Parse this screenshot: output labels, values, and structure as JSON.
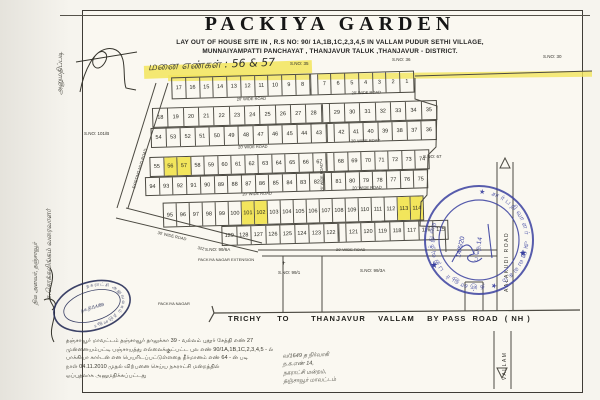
{
  "title": "PACKIYA GARDEN",
  "subtitle1": "LAY OUT OF HOUSE SITE IN , R.S NO: 90/ 1A,1B,1C,2,3,4,5 IN VALLAM PUDUR SETHI VILLAGE,",
  "subtitle2": "MUNNAIYAMPATTI PANCHAYAT , THANJAVUR TALUK ,THANJAVUR - DISTRICT.",
  "handwritten_note": "மனை எண்கள் : 56 & 57",
  "colors": {
    "highlight": "#f2e55c",
    "stamp_blue": "#3a41a0",
    "stamp_dark": "#272e58",
    "ink": "#2b2b2b"
  },
  "layout": {
    "highlighted_plots": [
      "56",
      "57",
      "101",
      "102",
      "113",
      "114"
    ],
    "rows": [
      {
        "x": 172,
        "y": 78,
        "w": 243,
        "h": 22,
        "gap_after": 9,
        "cells": [
          "17",
          "16",
          "15",
          "14",
          "13",
          "12",
          "11",
          "10",
          "9",
          "8",
          "7",
          "6",
          "5",
          "4",
          "3",
          "2",
          "1"
        ]
      },
      {
        "x": 152,
        "y": 108,
        "w": 285,
        "h": 20,
        "gap_after": 10,
        "cells": [
          "18",
          "19",
          "20",
          "21",
          "22",
          "23",
          "24",
          "25",
          "26",
          "27",
          "28",
          "29",
          "30",
          "31",
          "32",
          "33",
          "34",
          "35"
        ]
      },
      {
        "x": 150,
        "y": 128,
        "w": 286,
        "h": 20,
        "gap_after": 11,
        "cells": [
          "54",
          "53",
          "52",
          "51",
          "50",
          "49",
          "48",
          "47",
          "46",
          "45",
          "44",
          "43",
          "42",
          "41",
          "40",
          "39",
          "38",
          "37",
          "36"
        ]
      },
      {
        "x": 148,
        "y": 157,
        "w": 280,
        "h": 20,
        "gap_after": 12,
        "cells": [
          "55",
          "56",
          "57",
          "58",
          "59",
          "60",
          "61",
          "62",
          "63",
          "64",
          "65",
          "66",
          "67",
          "68",
          "69",
          "70",
          "71",
          "72",
          "73",
          "74"
        ]
      },
      {
        "x": 143,
        "y": 177,
        "w": 283,
        "h": 19,
        "gap_after": 12,
        "cells": [
          "94",
          "93",
          "92",
          "91",
          "90",
          "89",
          "88",
          "87",
          "86",
          "85",
          "84",
          "83",
          "82",
          "81",
          "80",
          "79",
          "78",
          "77",
          "76",
          "75"
        ]
      },
      {
        "x": 160,
        "y": 203,
        "w": 261,
        "h": 25,
        "cells": [
          "95",
          "96",
          "97",
          "98",
          "99",
          "100",
          "101",
          "102",
          "103",
          "104",
          "105",
          "106",
          "107",
          "108",
          "109",
          "110",
          "111",
          "112",
          "113",
          "114"
        ]
      },
      {
        "x": 218,
        "y": 228,
        "w": 227,
        "h": 20,
        "gap_after": 7,
        "cells": [
          "129",
          "128",
          "127",
          "126",
          "125",
          "124",
          "123",
          "122",
          "121",
          "120",
          "119",
          "118",
          "117",
          "116",
          "115"
        ]
      }
    ],
    "grid_labels": [
      {
        "name": "road-20-label-1",
        "t": "20' WIDE ROAD",
        "x": 237,
        "y": 100,
        "s": 4
      },
      {
        "name": "road-20-label-2",
        "t": "20' WIDE ROAD",
        "x": 352,
        "y": 97,
        "s": 4
      },
      {
        "name": "road-20-label-3",
        "t": "20' WIDE ROAD",
        "x": 237,
        "y": 148,
        "s": 4
      },
      {
        "name": "road-20-label-4",
        "t": "20' WIDE ROAD",
        "x": 350,
        "y": 145,
        "s": 4
      },
      {
        "name": "road-20-label-5",
        "t": "20' WIDE ROAD",
        "x": 240,
        "y": 195,
        "s": 4
      },
      {
        "name": "road-20-label-6",
        "t": "20' WIDE ROAD",
        "x": 350,
        "y": 192,
        "s": 4
      },
      {
        "name": "road-20-vertical-label",
        "t": "20' WIDE ROAD",
        "x": 319,
        "y": 196,
        "s": 3.8,
        "r": -90
      }
    ],
    "page_labels": [
      {
        "name": "survey-no-35",
        "t": "S.NO: 35",
        "x": 290,
        "y": 62,
        "s": 4.5
      },
      {
        "name": "survey-no-36",
        "t": "S.NO: 36",
        "x": 392,
        "y": 58,
        "s": 4.5
      },
      {
        "name": "survey-no-30",
        "t": "S.NO: 30",
        "x": 543,
        "y": 55,
        "s": 4.5
      },
      {
        "name": "survey-no-101b",
        "t": "S.NO: 101/B",
        "x": 84,
        "y": 132,
        "s": 4.5
      },
      {
        "name": "survey-no-67",
        "t": "S.NO: 67",
        "x": 423,
        "y": 155,
        "s": 4.5
      },
      {
        "name": "survey-no-99-6a",
        "t": "S.NO: 99/6A",
        "x": 205,
        "y": 248,
        "s": 4.5
      },
      {
        "name": "survey-no-99-1",
        "t": "S.NO: 99/1",
        "x": 278,
        "y": 271,
        "s": 4.5
      },
      {
        "name": "survey-no-99-3a",
        "t": "S.NO: 99/3A",
        "x": 360,
        "y": 269,
        "s": 4.5
      },
      {
        "name": "cross-mark",
        "t": "+",
        "x": 282,
        "y": 261,
        "s": 6
      },
      {
        "name": "road-20-bottom-label",
        "t": "20' WIDE ROAD",
        "x": 336,
        "y": 248,
        "s": 4
      },
      {
        "name": "road-30-label",
        "t": "30' WIDE ROAD",
        "x": 158,
        "y": 231,
        "s": 4,
        "r": 13
      },
      {
        "name": "dim-322",
        "t": "322'",
        "x": 198,
        "y": 246,
        "s": 4,
        "r": 13
      },
      {
        "name": "mud-road-label",
        "t": "EXISTING MUD ROAD",
        "x": 132,
        "y": 188,
        "s": 4,
        "r": -73
      },
      {
        "name": "aalakudi-road-label",
        "t": "AALAKUDI  ROAD",
        "x": 505,
        "y": 292,
        "s": 5,
        "r": -90,
        "cls": "ls1"
      },
      {
        "name": "vallam-label",
        "t": "VALLAM",
        "x": 503,
        "y": 380,
        "s": 5,
        "r": -90,
        "cls": "ls1"
      },
      {
        "name": "packiya-nagar-extension-label",
        "t": "PACKIYA NAGAR EXTENSION",
        "x": 198,
        "y": 258,
        "s": 4
      },
      {
        "name": "packiya-nagar-label",
        "t": "PACKIYA NAGAR",
        "x": 158,
        "y": 302,
        "s": 4
      },
      {
        "name": "bypass-road-label",
        "t": "TRICHY     TO       THANJAVUR    VALLAM    BY PASS  ROAD  ( NH )",
        "x": 228,
        "y": 315,
        "s": 7.5,
        "cls": "pre"
      }
    ]
  },
  "stamps": {
    "round": {
      "ring": "★ சார்பதிவாளர் அலுவலகம் ★ தஞ்சாவூர் பதிவுத்துறை",
      "line1": "14/6/20",
      "line2": "ப.நெ.14"
    },
    "oval": {
      "ring": "நகராட்சி அலுவலகம் தஞ்சாவூர்",
      "center": "நக.நி/14/89"
    }
  },
  "bottom_text": {
    "lines": [
      "தஞ்சாவூர் மாவட்டம் தஞ்சாவூர் தாலுக்கா 39 - வல்லம் புதூர் சேத்தி எண் 27",
      "முன்னையம்பட்டி பஞ்சாயத்து எல்லைக்குட்பட்ட புல எண் 90/1A,1B,1C,2,3,4,5 - ல்",
      "பாக்கியா கார்டன் என பெயரிடப்பட்டுள்ளதை தீர்மானம் எண் 64 - ன் படி",
      "நாள் 04.11.2010 முதல் விற்பனை செய்ய நகராட்சி மன்றத்தில்",
      "ஒப்புதலாக அனுமதிக்கப்பட்டது"
    ]
  },
  "bottom_right_note": {
    "lines": [
      "வ/1649 த நிர்வாகி",
      "ந.க.எண் 14,",
      "நகராட்சி மன்றம்,",
      "தஞ்சாவூர் மாவட்டம்"
    ]
  },
  "side_notes": {
    "top": "அனுமதிப்படி",
    "mid1": "சு.சொக்கலிங்கம் வரைவாளர்",
    "mid2": "நில அளவர், தஞ்சாவூர்"
  }
}
